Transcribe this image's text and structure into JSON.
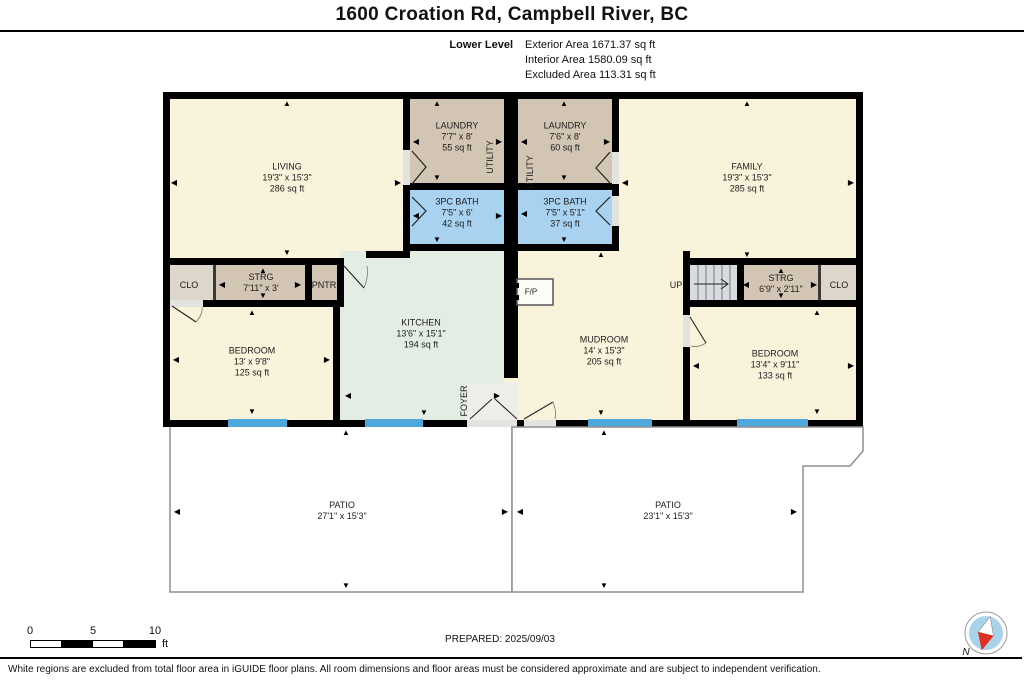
{
  "header": {
    "title": "1600 Croation Rd, Campbell River, BC",
    "level_label": "Lower Level",
    "area_lines": [
      "Exterior Area 1671.37 sq ft",
      "Interior Area 1580.09 sq ft",
      "Excluded Area 113.31 sq ft"
    ]
  },
  "rooms": {
    "living": {
      "name": "LIVING",
      "dims": "19'3\" x 15'3\"",
      "area": "286 sq ft"
    },
    "laundry_left": {
      "name": "LAUNDRY",
      "dims": "7'7\" x 8'",
      "area": "55 sq ft"
    },
    "laundry_right": {
      "name": "LAUNDRY",
      "dims": "7'6\" x 8'",
      "area": "60 sq ft"
    },
    "family": {
      "name": "FAMILY",
      "dims": "19'3\" x 15'3\"",
      "area": "285 sq ft"
    },
    "bath_left": {
      "name": "3PC BATH",
      "dims": "7'5\" x 6'",
      "area": "42 sq ft"
    },
    "bath_right": {
      "name": "3PC BATH",
      "dims": "7'5\" x 5'1\"",
      "area": "37 sq ft"
    },
    "storage_left": {
      "name": "STRG",
      "dims": "7'11\" x 3'"
    },
    "storage_right": {
      "name": "STRG",
      "dims": "6'9\" x 2'11\""
    },
    "bedroom_left": {
      "name": "BEDROOM",
      "dims": "13' x 9'8\"",
      "area": "125 sq ft"
    },
    "bedroom_right": {
      "name": "BEDROOM",
      "dims": "13'4\" x 9'11\"",
      "area": "133 sq ft"
    },
    "kitchen": {
      "name": "KITCHEN",
      "dims": "13'6\" x 15'1\"",
      "area": "194 sq ft"
    },
    "mudroom": {
      "name": "MUDROOM",
      "dims": "14' x 15'3\"",
      "area": "205 sq ft"
    },
    "patio_left": {
      "name": "PATIO",
      "dims": "27'1\" x 15'3\""
    },
    "patio_right": {
      "name": "PATIO",
      "dims": "23'1\" x 15'3\""
    }
  },
  "small_labels": {
    "closet_left": "CLO",
    "closet_right": "CLO",
    "pantry": "PNTR",
    "up": "UP",
    "fireplace": "F/P",
    "foyer": "FOYER",
    "utility_left": "UTILITY",
    "utility_right": "UTILITY"
  },
  "scale_bar": {
    "ticks": [
      "0",
      "5",
      "10"
    ],
    "unit": "ft"
  },
  "prepared_label": "PREPARED: 2025/09/03",
  "compass": {
    "north_label": "N"
  },
  "footer": {
    "disclaimer": "White regions are excluded from total floor area in iGUIDE floor plans. All room dimensions and floor areas must be considered approximate and are subject to independent verification."
  },
  "icons": {
    "arrow_up": "▲",
    "arrow_down": "▼",
    "arrow_left": "◀",
    "arrow_right": "▶"
  },
  "colors": {
    "room_cream": "#FAF3DC",
    "room_taupe": "#D2C5B3",
    "room_taupe_light": "#DDD6CB",
    "bath_blue": "#A9D2F0",
    "kitchen_mint": "#E3EDE4",
    "window_blue": "#4FA8DC",
    "wall_black": "#000000",
    "stairs_gray": "#D8DCE1",
    "compass_blue": "#A9D3EA",
    "compass_red": "#E03020"
  }
}
